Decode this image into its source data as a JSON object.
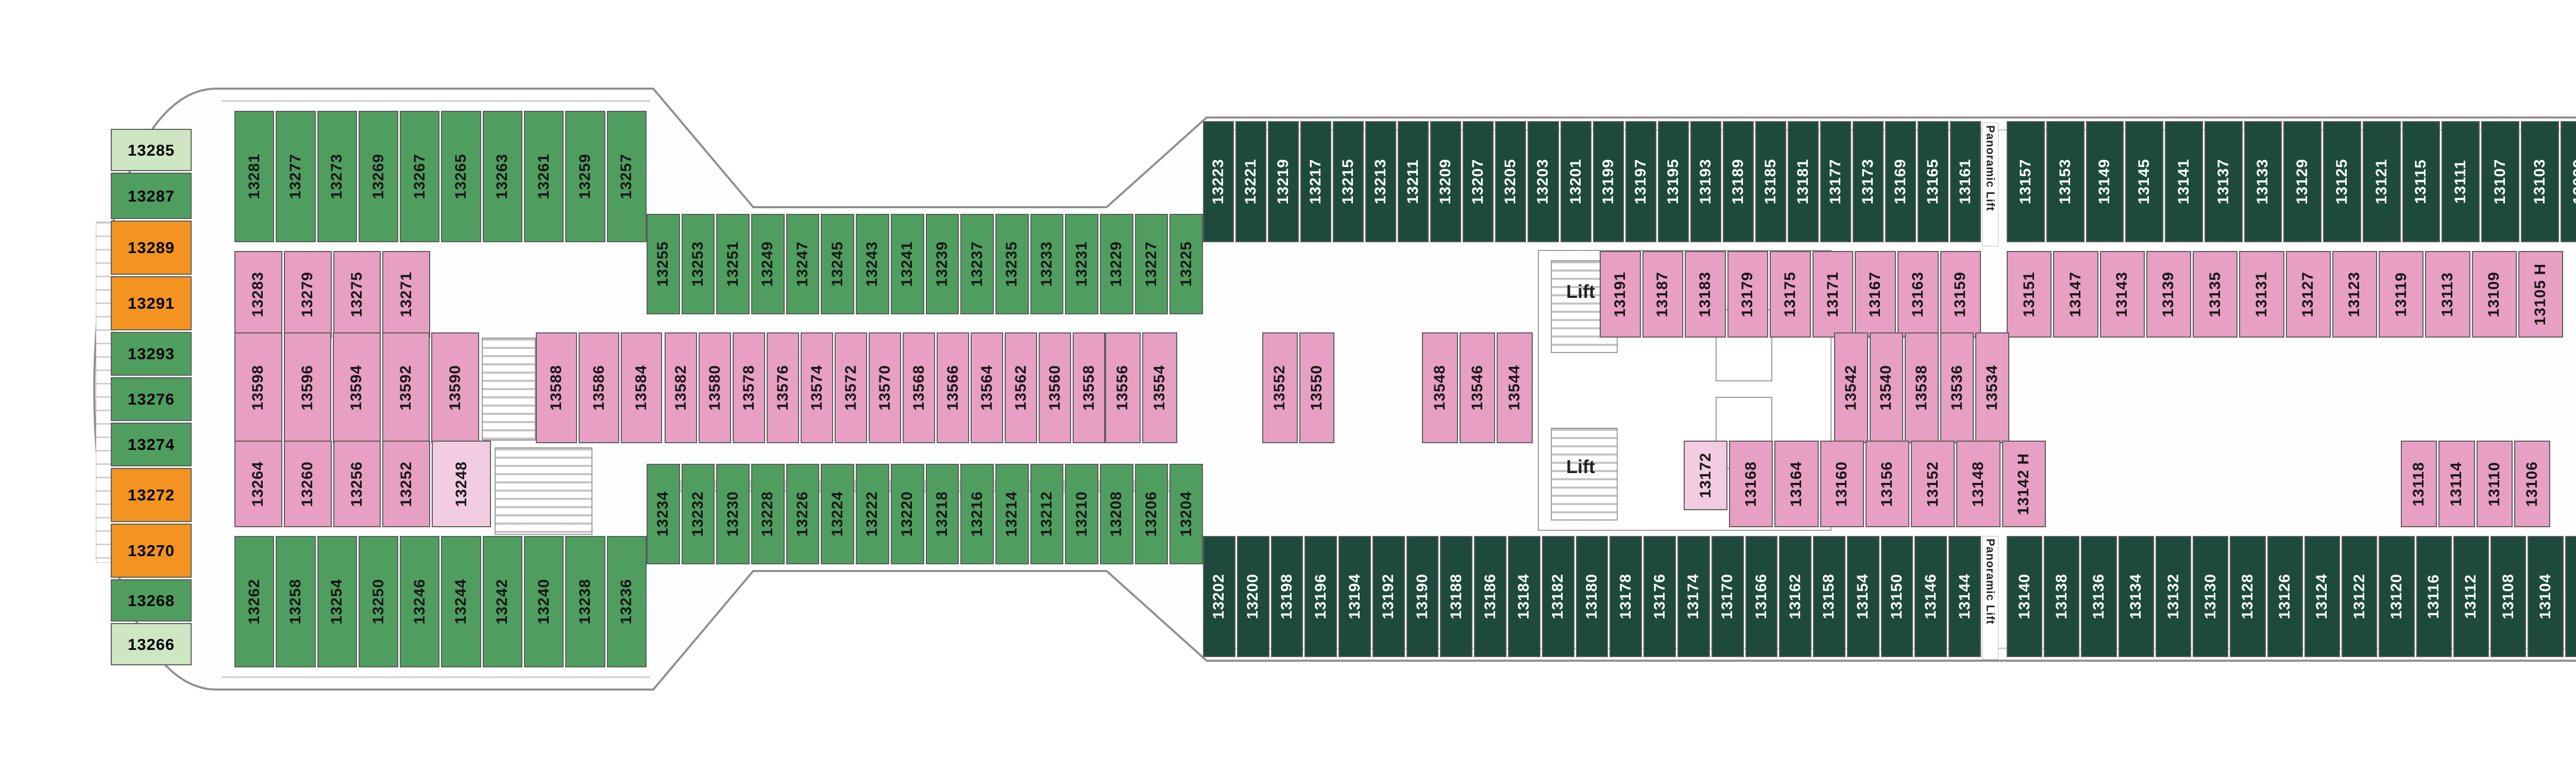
{
  "palette": {
    "green": "#4f9e60",
    "dark_green": "#1d4a3c",
    "light_green": "#cfe6c2",
    "pink": "#e79fc3",
    "light_pink": "#f2cce0",
    "orange": "#f2941f",
    "brown": "#6f6150",
    "deck_gray": "#e8e8e8",
    "wall": "#5a5a5a"
  },
  "labels": {
    "lift": "Lift",
    "panoramic_lift": "Panoramic Lift"
  },
  "stern_column": [
    {
      "n": "13285",
      "c": "light_green"
    },
    {
      "n": "13287",
      "c": "green"
    },
    {
      "n": "13289",
      "c": "orange"
    },
    {
      "n": "13291",
      "c": "orange"
    },
    {
      "n": "13293",
      "c": "green"
    },
    {
      "n": "13276",
      "c": "green"
    },
    {
      "n": "13274",
      "c": "green"
    },
    {
      "n": "13272",
      "c": "orange"
    },
    {
      "n": "13270",
      "c": "orange"
    },
    {
      "n": "13268",
      "c": "green"
    },
    {
      "n": "13266",
      "c": "light_green"
    }
  ],
  "rows": {
    "port_outer": {
      "stern": [
        "13281",
        "13277",
        "13273",
        "13269",
        "13267",
        "13265",
        "13263",
        "13261",
        "13259",
        "13257"
      ],
      "waist": [
        "13255",
        "13253",
        "13251",
        "13249",
        "13247",
        "13245",
        "13243",
        "13241",
        "13239",
        "13237",
        "13235",
        "13233",
        "13231",
        "13229",
        "13227",
        "13225"
      ],
      "dark_aft": [
        "13223",
        "13221",
        "13219",
        "13217",
        "13215",
        "13213",
        "13211",
        "13209",
        "13207",
        "13205",
        "13203",
        "13201",
        "13199",
        "13197",
        "13195",
        "13193",
        "13189",
        "13185",
        "13181",
        "13177",
        "13173",
        "13169",
        "13165",
        "13161"
      ],
      "dark_fwd": [
        "13157",
        "13153",
        "13149",
        "13145",
        "13141",
        "13137",
        "13133",
        "13129",
        "13125",
        "13121",
        "13115",
        "13111",
        "13107",
        "13103",
        "13099",
        "13095"
      ],
      "notch": [
        "13093",
        "13091",
        "13089",
        "13087",
        "13085",
        "13083",
        "13081",
        "13079",
        "13077",
        "13075 H",
        "13073 H"
      ],
      "fwd": [
        "13069",
        "13065",
        "13061",
        "13059",
        "13057",
        "13055",
        "13053",
        "13051",
        "13049",
        "13047",
        "13045",
        "13043",
        "13041",
        "13037",
        "13033",
        "13029",
        "13025",
        "13021",
        "13015",
        "13011",
        "13007",
        "13003"
      ],
      "corner": [
        "13001 ♦"
      ]
    },
    "port_inner": {
      "stern": [
        "13283",
        "13279",
        "13275",
        "13271"
      ],
      "mid_aft": [
        "13191",
        "13187",
        "13183",
        "13179",
        "13175",
        "13171",
        "13167",
        "13163",
        "13159"
      ],
      "mid_fwd": [
        "13151",
        "13147",
        "13143",
        "13139",
        "13135",
        "13131",
        "13127",
        "13123",
        "13119",
        "13113",
        "13109",
        "13105 H"
      ],
      "single": [
        "13097 H"
      ],
      "fwd": [
        "13071",
        "13067",
        "13063"
      ],
      "bow": [
        "13039",
        "13035",
        "13031",
        "13027",
        "13023",
        "13019",
        "13013",
        "13009",
        "13005"
      ]
    },
    "center": {
      "aft_a": [
        "13598",
        "13596",
        "13594",
        "13592",
        "13590"
      ],
      "aft_b": [
        "13588",
        "13586",
        "13584"
      ],
      "waist": [
        "13582",
        "13580",
        "13578",
        "13576",
        "13574",
        "13572",
        "13570",
        "13568",
        "13566",
        "13564",
        "13562",
        "13560",
        "13558"
      ],
      "mid_a": [
        "13556",
        "13554"
      ],
      "mid_b": [
        "13552",
        "13550"
      ],
      "mid_c": [
        "13548",
        "13546",
        "13544"
      ],
      "mid_d": [
        "13542",
        "13540",
        "13538",
        "13536",
        "13534"
      ],
      "fwd": [
        "13532",
        "13530",
        "13528",
        "13526",
        "13524",
        "13522",
        "13520",
        "13518",
        "13516"
      ],
      "pair": [
        "13514",
        "13512"
      ],
      "bow": [
        "13510",
        "13508",
        "13506",
        "13504"
      ],
      "bow_h": [
        "13502"
      ]
    },
    "stbd_inner": {
      "stern": [
        "13264",
        "13260",
        "13256",
        "13252"
      ],
      "stern_light": [
        "13248"
      ],
      "mid_small": [
        "13172"
      ],
      "mid": [
        "13168",
        "13164",
        "13160",
        "13156",
        "13152",
        "13148",
        "13142 H"
      ],
      "mid2": [
        "13118",
        "13114",
        "13110",
        "13106"
      ],
      "single": [
        "13098 H"
      ],
      "fwd": [
        "13072",
        "13068",
        "13064",
        "13060"
      ],
      "bow": [
        "13038 H",
        "13034",
        "13030",
        "13026",
        "13022",
        "13018",
        "13014",
        "13010",
        "13006"
      ]
    },
    "stbd_outer": {
      "stern": [
        "13262",
        "13258",
        "13254",
        "13250",
        "13246",
        "13244",
        "13242",
        "13240",
        "13238",
        "13236"
      ],
      "waist": [
        "13234",
        "13232",
        "13230",
        "13228",
        "13226",
        "13224",
        "13222",
        "13220",
        "13218",
        "13216",
        "13214",
        "13212",
        "13210",
        "13208",
        "13206",
        "13204"
      ],
      "dark_aft": [
        "13202",
        "13200",
        "13198",
        "13196",
        "13194",
        "13192",
        "13190",
        "13188",
        "13186",
        "13184",
        "13182",
        "13180",
        "13178",
        "13176",
        "13174",
        "13170",
        "13166",
        "13162",
        "13158",
        "13154",
        "13150",
        "13146",
        "13144"
      ],
      "dark_fwd": [
        "13140",
        "13138",
        "13136",
        "13134",
        "13132",
        "13130",
        "13128",
        "13126",
        "13124",
        "13122",
        "13120",
        "13116",
        "13112",
        "13108",
        "13104",
        "13100",
        "13096"
      ],
      "notch": [
        "13094",
        "13092",
        "13090",
        "13088",
        "13086",
        "13084",
        "13082",
        "13080",
        "13078",
        "13076 H",
        "13074 H"
      ],
      "fwd": [
        "13070",
        "13066",
        "13062",
        "13058",
        "13056",
        "13054",
        "13052",
        "13050",
        "13048",
        "13046",
        "13044",
        "13042",
        "13040",
        "13036",
        "13032",
        "13028",
        "13024",
        "13020",
        "13016",
        "13012",
        "13008",
        "13004"
      ],
      "corner": [
        "13002 ♦"
      ]
    },
    "suites": [
      "12005 ♦",
      "12003 ♦",
      "12001 ♦",
      "12004 ♦",
      "12006 ♦",
      "12008 ♦"
    ]
  }
}
